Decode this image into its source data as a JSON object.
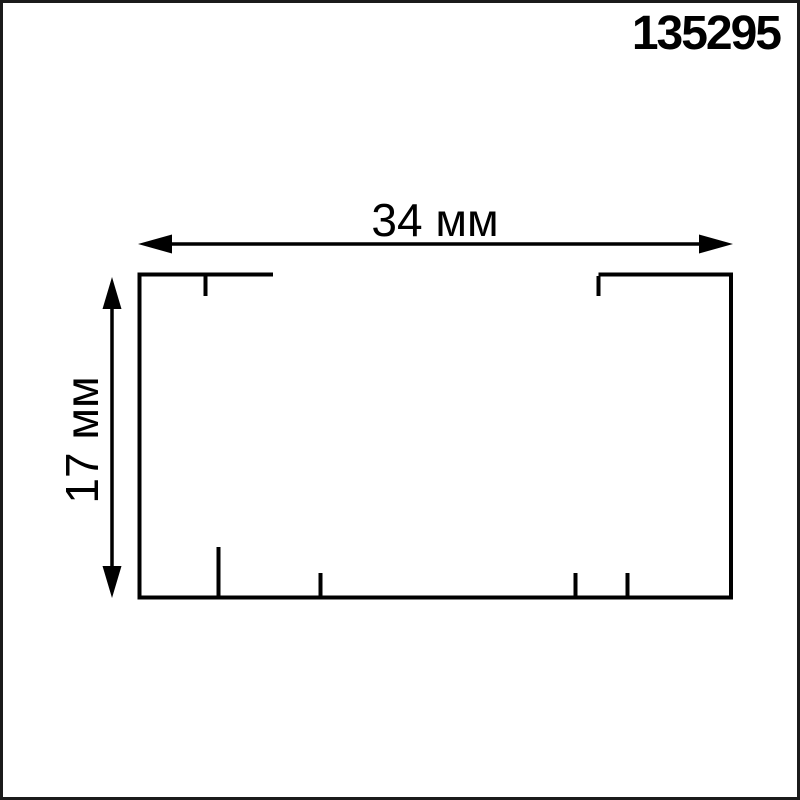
{
  "meta": {
    "background_color": "#ffffff",
    "ink_color": "#000000",
    "frame_color": "#1b1b1b"
  },
  "header": {
    "part_number": "135295"
  },
  "drawing": {
    "type": "technical-cross-section",
    "width_dimension_label": "34 мм",
    "height_dimension_label": "17 мм"
  }
}
